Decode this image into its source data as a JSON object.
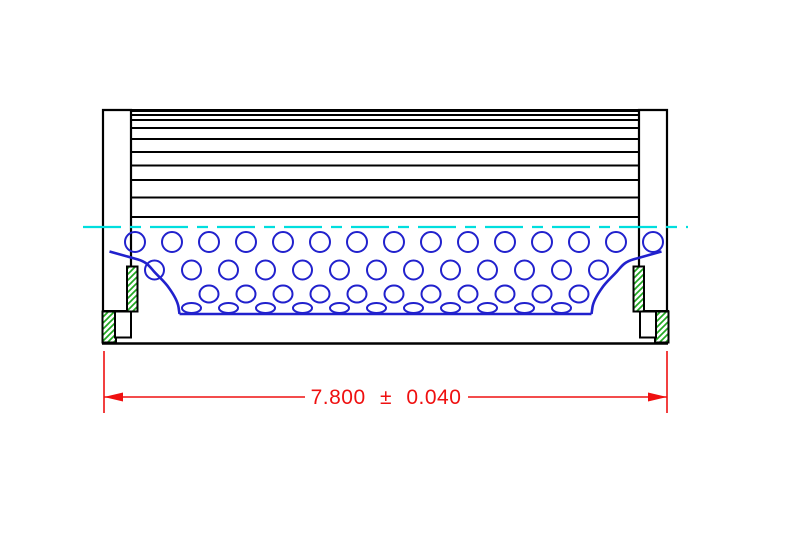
{
  "title": "Filter element side section drawing",
  "colors": {
    "outline": "#000000",
    "core": "#2121cd",
    "centerline": "#00dede",
    "hatch": "#22a822",
    "dimension": "#ef1010"
  },
  "dimension": {
    "label": "7.800 ± 0.040",
    "value": "7.800",
    "plus_minus": "±",
    "tolerance": "0.040"
  },
  "drawing": {
    "body": {
      "left": 131,
      "right": 639,
      "top_edge_y": 110.5,
      "pleat_bottom_y": 217
    },
    "pleat_lines_y": [
      115,
      120,
      128,
      139,
      152,
      165.5,
      180,
      197.5,
      217
    ],
    "centerline": {
      "y": 227,
      "x1": 83,
      "x2": 688
    },
    "hole_rows": [
      {
        "y": 242,
        "rx": 10,
        "ry": 10,
        "x_start": 135,
        "spacing": 37,
        "count": 15
      },
      {
        "y": 270,
        "rx": 9.5,
        "ry": 9.5,
        "x_start": 154.5,
        "spacing": 37,
        "count": 13
      },
      {
        "y": 294,
        "rx": 9.5,
        "ry": 8.5,
        "x_start": 209,
        "spacing": 37,
        "count": 11
      },
      {
        "y": 308,
        "rx": 9.5,
        "ry": 5,
        "x_start": 191.5,
        "spacing": 37,
        "count": 11
      }
    ]
  }
}
